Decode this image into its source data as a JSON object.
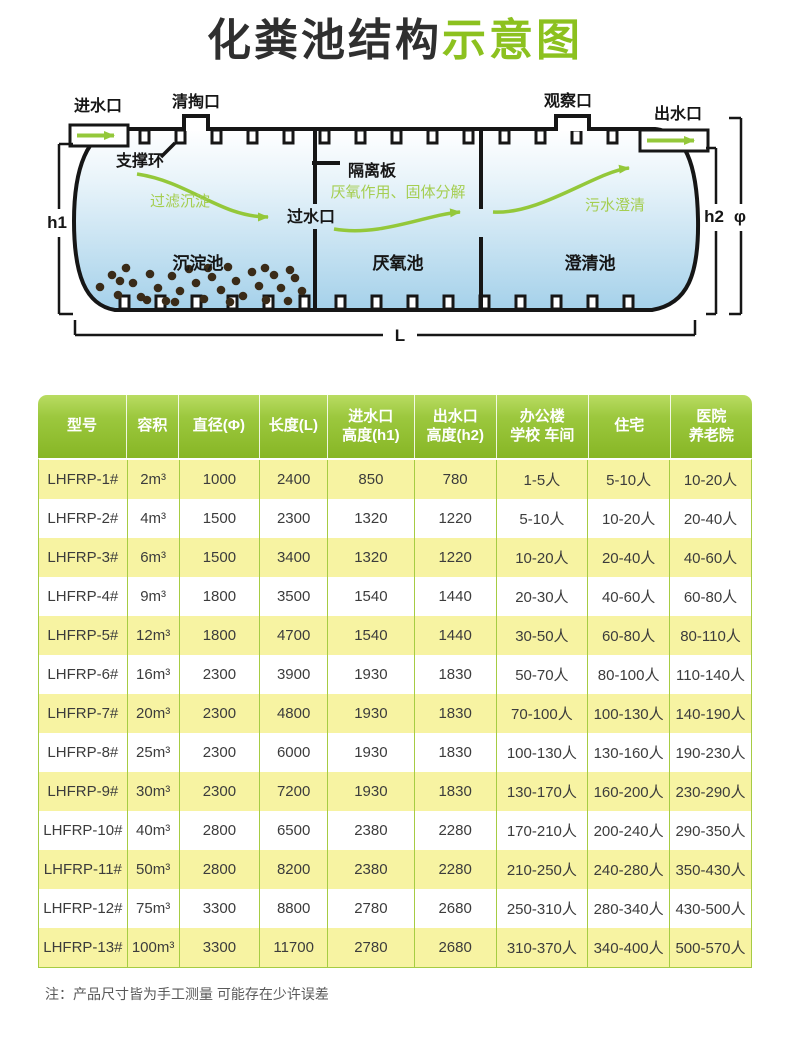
{
  "title": {
    "dark": "化粪池结构",
    "green": "示意图"
  },
  "diagram": {
    "inlet_label": "进水口",
    "clean_port_label": "清掏口",
    "observe_port_label": "观察口",
    "outlet_label": "出水口",
    "support_ring_label": "支撑环",
    "divider_label": "隔离板",
    "water_pass_label": "过水口",
    "flow_settle_label": "过滤沉淀",
    "flow_anaerobic_label": "厌氧作用、固体分解",
    "flow_clarify_label": "污水澄清",
    "chamber1_label": "沉淀池",
    "chamber2_label": "厌氧池",
    "chamber3_label": "澄清池",
    "dim_h1": "h1",
    "dim_h2": "h2",
    "dim_phi": "φ",
    "dim_length": "L"
  },
  "table": {
    "headers": [
      "型号",
      "容积",
      "直径(Φ)",
      "长度(L)",
      "进水口\n高度(h1)",
      "出水口\n高度(h2)",
      "办公楼\n学校 车间",
      "住宅",
      "医院\n养老院"
    ],
    "rows": [
      [
        "LHFRP-1#",
        "2m³",
        "1000",
        "2400",
        "850",
        "780",
        "1-5人",
        "5-10人",
        "10-20人"
      ],
      [
        "LHFRP-2#",
        "4m³",
        "1500",
        "2300",
        "1320",
        "1220",
        "5-10人",
        "10-20人",
        "20-40人"
      ],
      [
        "LHFRP-3#",
        "6m³",
        "1500",
        "3400",
        "1320",
        "1220",
        "10-20人",
        "20-40人",
        "40-60人"
      ],
      [
        "LHFRP-4#",
        "9m³",
        "1800",
        "3500",
        "1540",
        "1440",
        "20-30人",
        "40-60人",
        "60-80人"
      ],
      [
        "LHFRP-5#",
        "12m³",
        "1800",
        "4700",
        "1540",
        "1440",
        "30-50人",
        "60-80人",
        "80-110人"
      ],
      [
        "LHFRP-6#",
        "16m³",
        "2300",
        "3900",
        "1930",
        "1830",
        "50-70人",
        "80-100人",
        "110-140人"
      ],
      [
        "LHFRP-7#",
        "20m³",
        "2300",
        "4800",
        "1930",
        "1830",
        "70-100人",
        "100-130人",
        "140-190人"
      ],
      [
        "LHFRP-8#",
        "25m³",
        "2300",
        "6000",
        "1930",
        "1830",
        "100-130人",
        "130-160人",
        "190-230人"
      ],
      [
        "LHFRP-9#",
        "30m³",
        "2300",
        "7200",
        "1930",
        "1830",
        "130-170人",
        "160-200人",
        "230-290人"
      ],
      [
        "LHFRP-10#",
        "40m³",
        "2800",
        "6500",
        "2380",
        "2280",
        "170-210人",
        "200-240人",
        "290-350人"
      ],
      [
        "LHFRP-11#",
        "50m³",
        "2800",
        "8200",
        "2380",
        "2280",
        "210-250人",
        "240-280人",
        "350-430人"
      ],
      [
        "LHFRP-12#",
        "75m³",
        "3300",
        "8800",
        "2780",
        "2680",
        "250-310人",
        "280-340人",
        "430-500人"
      ],
      [
        "LHFRP-13#",
        "100m³",
        "3300",
        "11700",
        "2780",
        "2680",
        "310-370人",
        "340-400人",
        "500-570人"
      ]
    ]
  },
  "note": "注：产品尺寸皆为手工测量 可能存在少许误差",
  "colors": {
    "accent_green": "#8cc11f",
    "header_gradient_top": "#b9dc62",
    "header_gradient_bottom": "#87b625",
    "grid_green": "#a6cc43",
    "row_yellow": "#f7f3a2",
    "arrow_green": "#94c83a",
    "green_label": "#a5ce51",
    "water_top": "#ffffff",
    "water_bottom": "#a5d1ea",
    "sediment_brown": "#3a2b18",
    "body_text": "#3c3c3c"
  }
}
